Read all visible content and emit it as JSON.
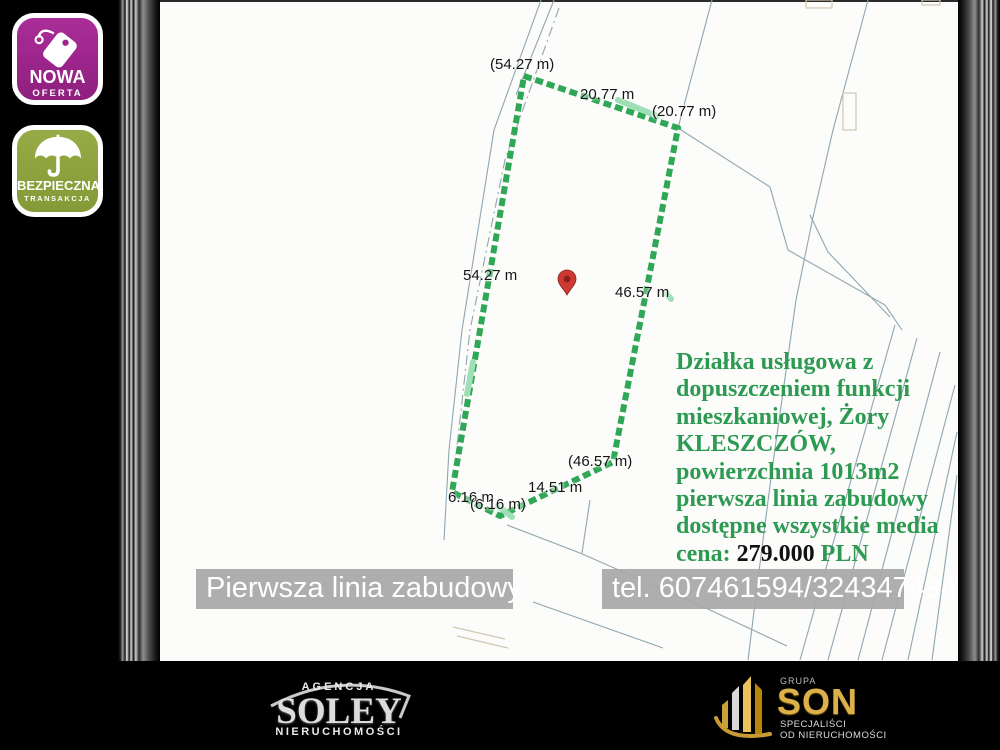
{
  "badges": {
    "new_offer": {
      "title": "NOWA",
      "subtitle": "OFERTA"
    },
    "safe_transaction": {
      "title": "BEZPIECZNA",
      "subtitle": "TRANSAKCJA"
    }
  },
  "icons": {
    "new_offer": "price-tag-icon",
    "safe_transaction": "umbrella-icon",
    "map_marker": "location-pin-icon"
  },
  "map": {
    "measurements": [
      "(54.27 m)",
      "20.77 m",
      "(20.77 m)",
      "54.27 m",
      "46.57 m",
      "(46.57 m)",
      "14.51 m",
      "6.16 m",
      "(6.16 m)"
    ]
  },
  "description": {
    "lines": [
      "Działka usługowa z",
      "dopuszczeniem funkcji",
      "mieszkaniowej, Żory",
      "KLESZCZÓW,",
      "powierzchnia 1013m2",
      "pierwsza linia zabudowy",
      "dostępne wszystkie media"
    ],
    "price_label": "cena:",
    "price_value": "279.000",
    "price_currency": "PLN"
  },
  "overlays": {
    "caption": "Pierwsza linia zabudowy",
    "phone": "tel. 607461594/324347494"
  },
  "footer": {
    "soley": {
      "top": "AGENCJA",
      "name": "SOLEY",
      "bottom": "NIERUCHOMOŚCI"
    },
    "son": {
      "top": "GRUPA",
      "name": "SON",
      "bottom1": "SPECJALIŚCI",
      "bottom2": "OD NIERUCHOMOŚCI"
    }
  },
  "colors": {
    "accent_green": "#2d9a52",
    "outline_green": "#2fa757",
    "badge_purple": "#9f2490",
    "badge_olive": "#8fa33f",
    "gold": "#dcb14a",
    "overlay_bar_gray": "#a8a8a8",
    "price_value_color": "#111111"
  }
}
